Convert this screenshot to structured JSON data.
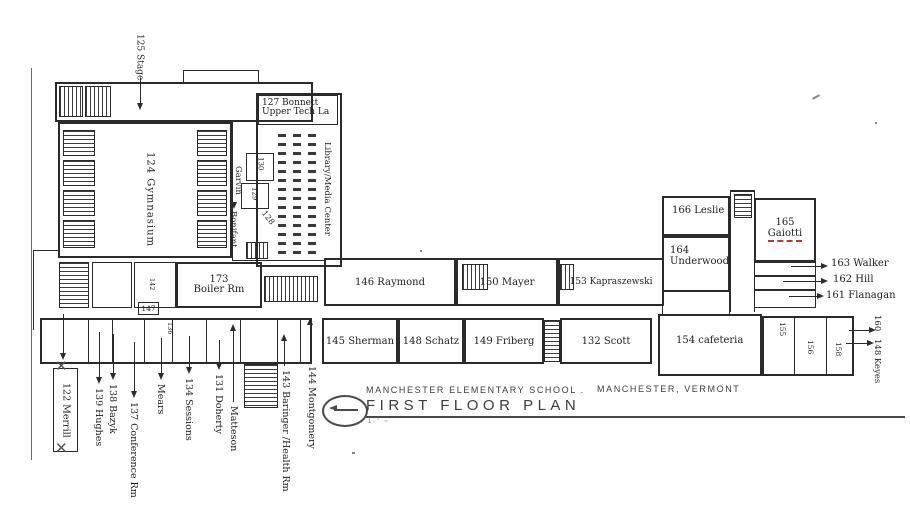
{
  "title_block": {
    "school": "MANCHESTER ELEMENTARY SCHOOL .",
    "location": "MANCHESTER, VERMONT",
    "plan_title": "FIRST FLOOR PLAN",
    "scale_marks": "1·' ~"
  },
  "north_wing": {
    "stage": "125 Stage",
    "gymnasium": "124 Gymnasium",
    "garvin": "Garvin",
    "bonifant": "Bonifant",
    "bonnett_line1": "127 Bonnett",
    "bonnett_line2": "Upper Tech La",
    "library": "Library/Media Center",
    "room_130": "130",
    "room_129": "129",
    "room_128": "128"
  },
  "center_wing": {
    "boiler_line1": "173",
    "boiler_line2": "Boiler Rm",
    "room_147": "147",
    "room_142": "142",
    "room_136": "136",
    "raymond": "146 Raymond",
    "mayer": "150 Mayer",
    "kapraszewski": "153 Kapraszewski"
  },
  "south_rooms": {
    "sherman": "145 Sherman",
    "schatz": "148 Schatz",
    "friberg": "149 Friberg",
    "scott": "132 Scott"
  },
  "east_wing": {
    "leslie": "166 Leslie",
    "underwood_line1": "164",
    "underwood_line2": "Underwood",
    "gaiotti_line1": "165",
    "gaiotti_line2": "Gaiotti",
    "walker": "163 Walker",
    "hill": "162 Hill",
    "flanagan": "161 Flanagan"
  },
  "cafeteria_wing": {
    "cafeteria": "154 cafeteria",
    "room_155": "155",
    "room_156": "156",
    "room_158": "158",
    "room_160": "160",
    "keyes": "148 Keyes"
  },
  "west_labels": {
    "x_mark": "✕",
    "merrill": "122 Merrill",
    "hughes": "139 Hughes",
    "bazyk": "138 Bazyk",
    "conference": "137 Conference Rm",
    "mears": "Mears",
    "sessions": "134 Sessions",
    "doherty": "131 Doherty",
    "matteson": "Matteson",
    "baringer": "143 Baringer /Health Rm",
    "montgomery": "144 Montgomery"
  },
  "colors": {
    "ink": "#2b2b2b",
    "accent_red": "#bb3a2a"
  }
}
